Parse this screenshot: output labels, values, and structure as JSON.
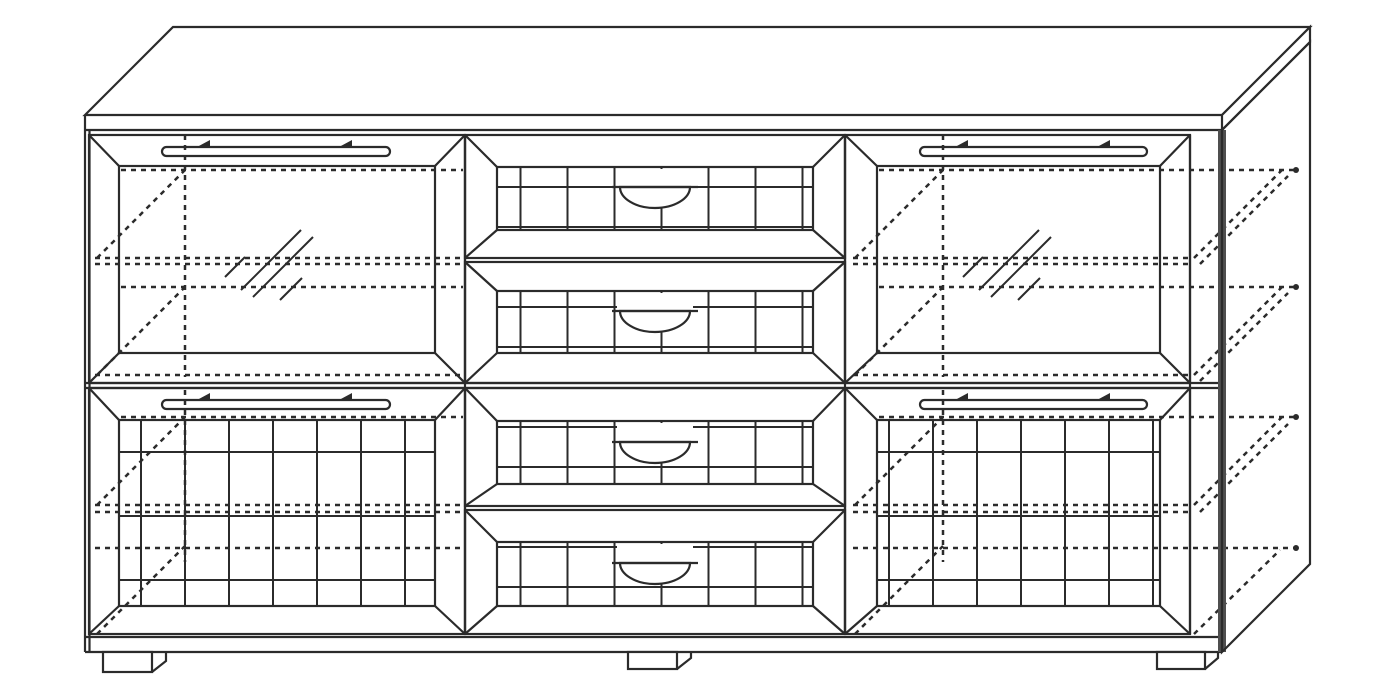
{
  "diagram": {
    "title": "Sideboard cabinet — technical line drawing",
    "type": "furniture-diagram",
    "projection": "oblique 45-degree cabinet projection",
    "style": {
      "background": "#ffffff",
      "line_color": "#2b2b2b",
      "edge_shadow_color": "#4f4f4f",
      "hidden_line_style": "dashed"
    },
    "components": {
      "top_panel": "top slab with overhang",
      "glass_door_left": "left upper door with glass pane and bar handle",
      "glass_door_right": "right upper door with glass pane and bar handle",
      "patterned_door_left": "left lower door with stepped zigzag relief and bar handle",
      "patterned_door_right": "right lower door with stepped zigzag relief and bar handle",
      "drawers": [
        "drawer 1",
        "drawer 2",
        "drawer 3",
        "drawer 4"
      ],
      "drawer_handle": "recessed half-round pull",
      "feet": [
        "left foot",
        "center foot",
        "right foot"
      ],
      "hidden_lines": "dashed interior shelf and depth lines projected onto right side panel"
    },
    "counts": {
      "glass_doors": 2,
      "patterned_doors": 2,
      "drawers": 4,
      "bar_handles": 4,
      "feet": 3
    }
  }
}
